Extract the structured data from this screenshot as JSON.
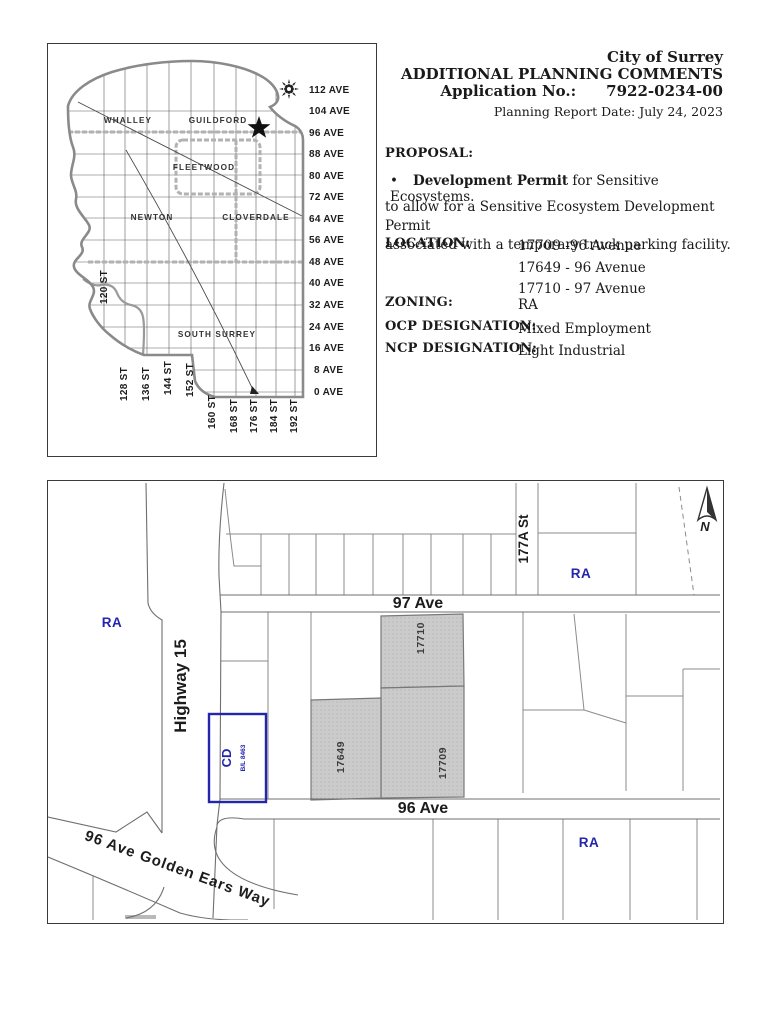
{
  "doc": {
    "org": "City of Surrey",
    "title": "ADDITIONAL PLANNING COMMENTS",
    "app_label": "Application No.:",
    "app_number": "7922-0234-00",
    "report_date": "Planning Report Date: July 24, 2023",
    "proposal_label": "PROPOSAL:",
    "proposal_bullet": "•",
    "proposal_bullet_bold": "Development Permit",
    "proposal_bullet_rest": " for Sensitive Ecosystems.",
    "proposal_line1": "to allow for a Sensitive Ecosystem Development Permit",
    "proposal_line2": "associated with a temporary truck parking facility.",
    "location_label": "LOCATION:",
    "location_1": "17709 -96 Avenue",
    "location_2": "17649 - 96 Avenue",
    "location_3": "17710 - 97 Avenue",
    "zoning_label": "ZONING:",
    "zoning_value": "RA",
    "ocp_label": "OCP DESIGNATION:",
    "ocp_value": "Mixed Employment",
    "ncp_label": "NCP DESIGNATION:",
    "ncp_value": "Light Industrial"
  },
  "overview_map": {
    "regions": {
      "whalley": "WHALLEY",
      "guildford": "GUILDFORD",
      "fleetwood": "FLEETWOOD",
      "newton": "NEWTON",
      "cloverdale": "CLOVERDALE",
      "south_surrey": "SOUTH SURREY"
    },
    "avenues": [
      "112 AVE",
      "104 AVE",
      "96 AVE",
      "88 AVE",
      "80 AVE",
      "72 AVE",
      "64 AVE",
      "56 AVE",
      "48 AVE",
      "40 AVE",
      "32 AVE",
      "24 AVE",
      "16 AVE",
      "8 AVE",
      "0 AVE"
    ],
    "streets": [
      "120 ST",
      "128 ST",
      "136 ST",
      "144 ST",
      "152 ST",
      "160 ST",
      "168 ST",
      "176 ST",
      "184 ST",
      "192 ST"
    ]
  },
  "site_map": {
    "highway": "Highway 15",
    "ave_97": "97 Ave",
    "ave_96": "96 Ave",
    "st_177a": "177A St",
    "golden_ears": "96 Ave Golden Ears Way",
    "zone_ra": "RA",
    "zone_cd": "CD",
    "cd_bylaw": "B/L 8463",
    "lot_17710": "17710",
    "lot_17649": "17649",
    "lot_17709": "17709",
    "north_label": "N"
  },
  "colors": {
    "zone_blue": "#2424ad",
    "lot_gray": "#cbcbcb"
  }
}
